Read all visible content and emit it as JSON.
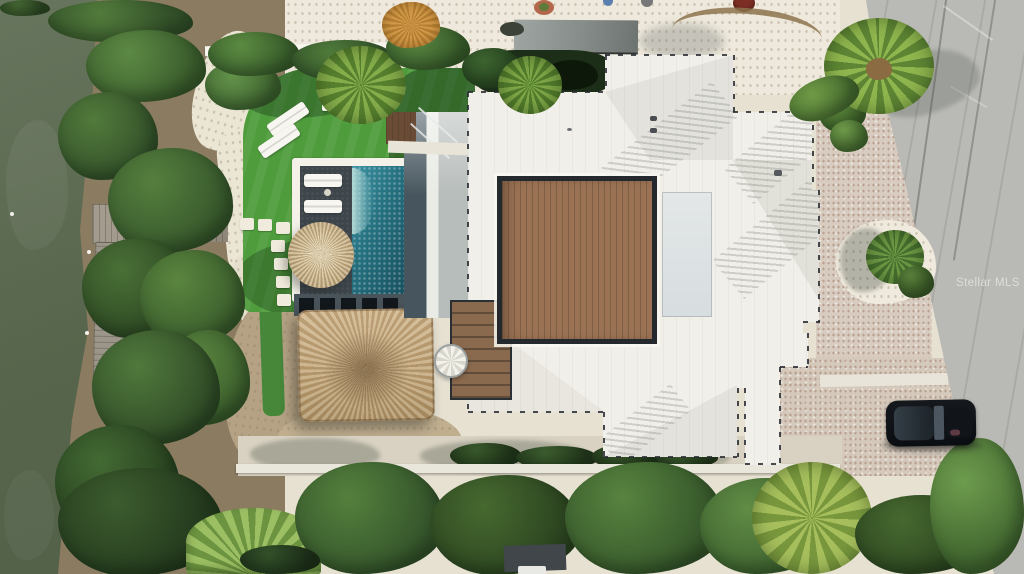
{
  "image": {
    "title": "Aerial drone photo of a waterfront home with pool, dock and tiki hut",
    "width_px": 1024,
    "height_px": 574
  },
  "watermark": {
    "text": "Stellar MLS",
    "color": "#ffffff"
  },
  "scene": {
    "water": {
      "label": "canal water",
      "color": "#5e6c54"
    },
    "dock": {
      "label": "weathered wood dock",
      "color": "#9c958a"
    },
    "lawn": {
      "label": "artificial turf lawn",
      "color": "#4f9c3c"
    },
    "pool": {
      "label": "swimming pool",
      "color": "#25707f"
    },
    "pool_deck": {
      "label": "dark pool deck",
      "color": "#3e464c"
    },
    "palapa_umbrella": {
      "label": "round thatched umbrella",
      "color": "#cdb88e"
    },
    "tiki_roof": {
      "label": "large thatched tiki roof",
      "color": "#c3aa82"
    },
    "house_roof": {
      "label": "white standing-seam metal roof",
      "color": "#f1efe9"
    },
    "wood_deck": {
      "label": "brown wood courtyard deck",
      "color": "#9b7254"
    },
    "garage_roof": {
      "label": "gray flat roof",
      "color": "#8a908d"
    },
    "road": {
      "label": "concrete street",
      "color": "#b9bab5"
    },
    "gravel_driveway": {
      "label": "shell gravel drive",
      "color": "#d7ccbf"
    },
    "car": {
      "label": "black parked car",
      "color": "#0e1116"
    },
    "sand": {
      "label": "white sand / gravel yard",
      "color": "#ece7da"
    },
    "trees": {
      "label": "coastal trees and palms",
      "color": "#47703a"
    }
  }
}
